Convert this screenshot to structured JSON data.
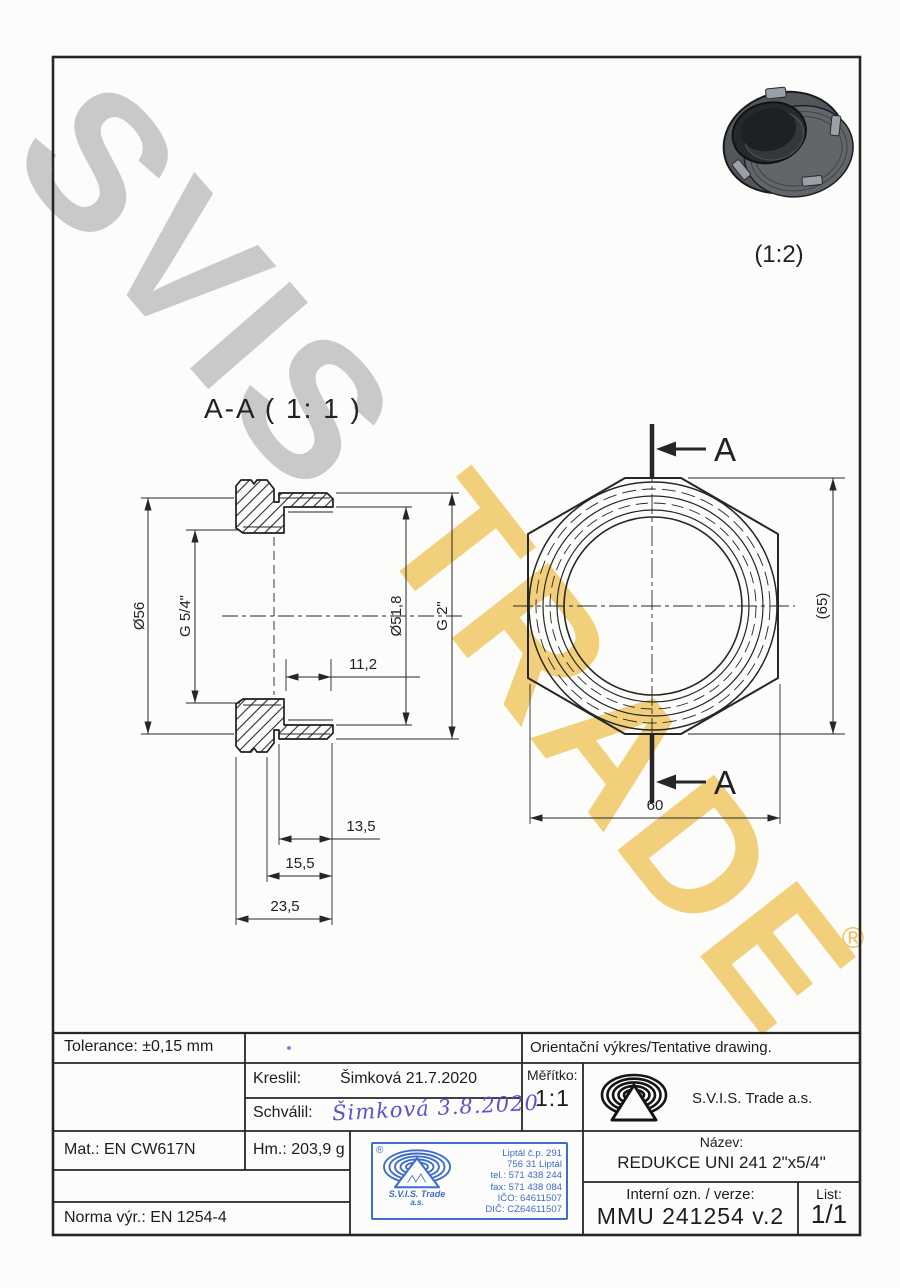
{
  "watermark": {
    "word1": "SVIS",
    "word2": "TRADE",
    "registered": "®"
  },
  "photo": {
    "scale_note": "(1:2)"
  },
  "section": {
    "title": "A-A ( 1: 1 )",
    "cut_label": "A",
    "dims": {
      "outer_diameter": "Ø56",
      "thread_small": "G 5/4\"",
      "bore_diameter": "Ø51,8",
      "thread_large": "G 2\"",
      "thread_length": "11,2",
      "step1": "13,5",
      "step2": "15,5",
      "total_length": "23,5"
    }
  },
  "front": {
    "across_corners": "(65)",
    "across_flats": "60",
    "cut_label": "A"
  },
  "titleblock": {
    "tolerance": "Tolerance: ±0,15 mm",
    "orientacni": "Orientační výkres/Tentative drawing.",
    "kreslil_label": "Kreslil:",
    "kreslil_value": "Šimková 21.7.2020",
    "schvalil_label": "Schválil:",
    "schvalil_signature": "Šimková 3.8.2020",
    "meritko_label": "Měřítko:",
    "meritko_value": "1:1",
    "company": "S.V.I.S. Trade a.s.",
    "mat": "Mat.: EN CW617N",
    "hm": "Hm.: 203,9 g",
    "norma": "Norma výr.: EN 1254-4",
    "nazev_label": "Název:",
    "nazev_value": "REDUKCE UNI 241 2\"x5/4\"",
    "interni_label": "Interní ozn. / verze:",
    "interni_value": "MMU 241254 v.2",
    "list_label": "List:",
    "list_value": "1/1"
  },
  "stamp": {
    "registered": "®",
    "company_line1": "S.V.I.S. Trade",
    "company_line2": "a.s.",
    "address": [
      "Liptál č.p. 291",
      "756 31 Liptál",
      "tel.: 571 438 244",
      "fax: 571 438 084",
      "IČO: 64611507",
      "DIČ: CZ64611507"
    ]
  },
  "colors": {
    "stamp_blue": "#3e6cc8",
    "ink": "#1d1d1d",
    "signature_ink": "#5a52c8",
    "watermark_gray": "#c7c7c7",
    "watermark_gold": "#f0c45c"
  }
}
